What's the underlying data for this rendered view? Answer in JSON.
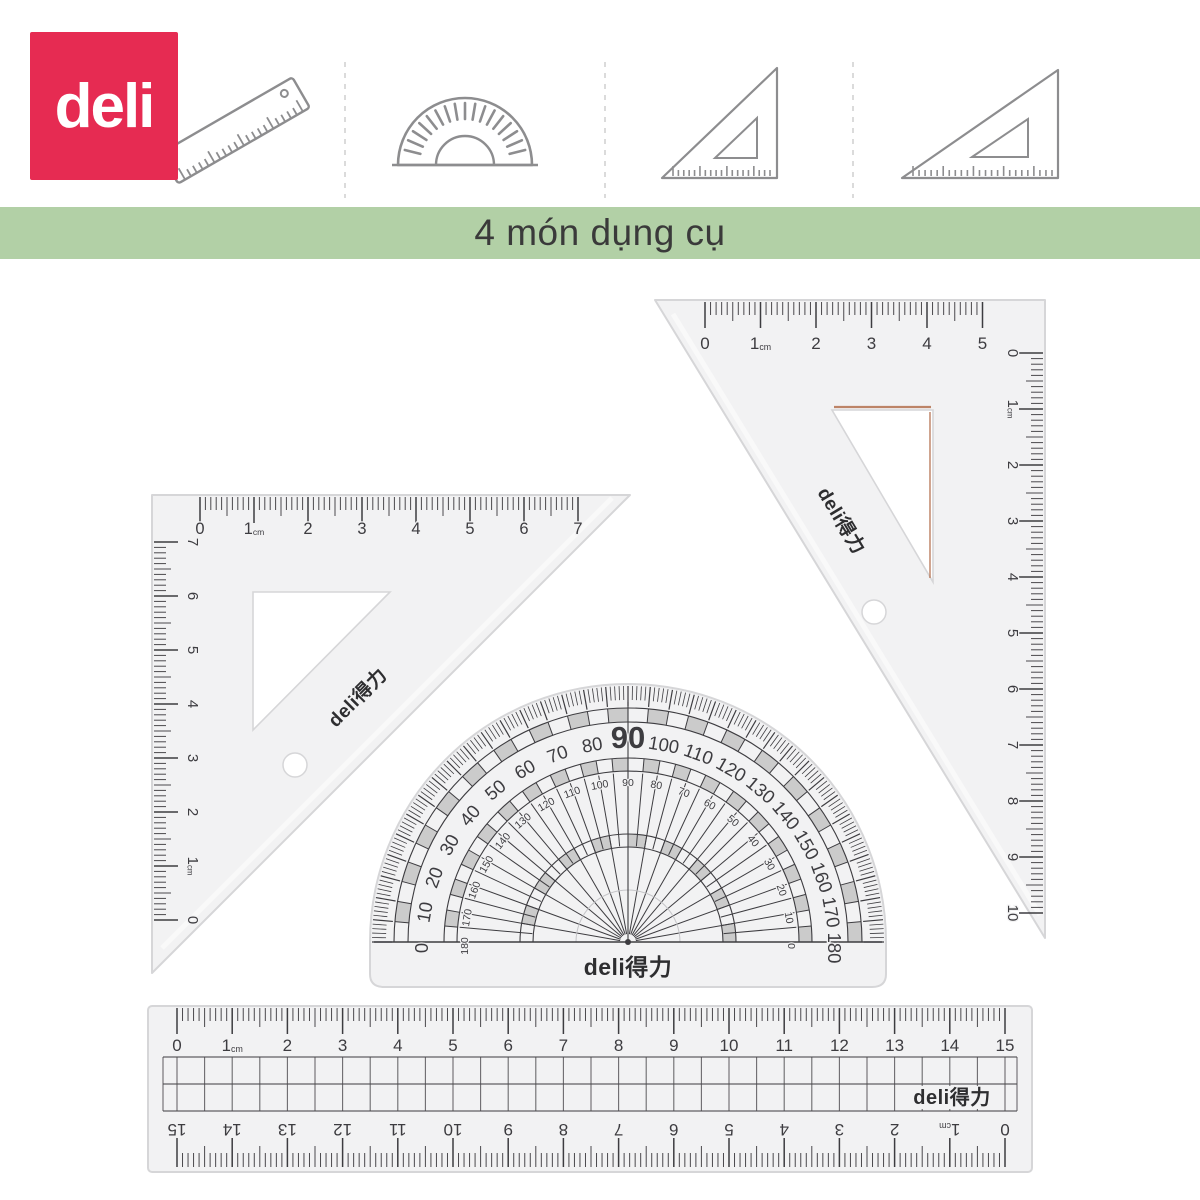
{
  "brand": {
    "logo_text": "deli",
    "logo_bg": "#e62b52",
    "logo_fg": "#ffffff",
    "mark_text": "deli得力"
  },
  "banner": {
    "text": "4 món dụng cụ",
    "bg": "#b2d0a6",
    "fg": "#3a3a3a"
  },
  "header": {
    "icons": [
      {
        "name": "ruler-icon"
      },
      {
        "name": "protractor-icon"
      },
      {
        "name": "set-square-45-icon"
      },
      {
        "name": "set-square-30-icon"
      }
    ]
  },
  "palette": {
    "tool_body": "#f2f2f3",
    "tool_edge": "#d6d6d8",
    "mark": "#3d3c40",
    "mark_light": "#4a484c",
    "icon_stroke": "#8d8d8f",
    "divider": "#d2d2d2",
    "copper": "#b4714f"
  },
  "tools": {
    "set_square_45": {
      "brand": "deli得力",
      "top_scale_labels": [
        "0",
        "1cm",
        "2",
        "3",
        "4",
        "5",
        "6",
        "7"
      ],
      "side_scale_labels": [
        "7",
        "6",
        "5",
        "4",
        "3",
        "2",
        "1cm",
        "0"
      ]
    },
    "set_square_30": {
      "brand": "deli得力",
      "top_scale_labels": [
        "0",
        "1cm",
        "2",
        "3",
        "4",
        "5"
      ],
      "side_scale_labels": [
        "0",
        "1cm",
        "2",
        "3",
        "4",
        "5",
        "6",
        "7",
        "8",
        "9",
        "10"
      ]
    },
    "protractor": {
      "brand": "deli得力",
      "outer_scale": [
        0,
        10,
        20,
        30,
        40,
        50,
        60,
        70,
        80,
        90,
        100,
        110,
        120,
        130,
        140,
        150,
        160,
        170,
        180
      ],
      "inner_scale": [
        180,
        170,
        160,
        150,
        140,
        130,
        120,
        110,
        100,
        90,
        80,
        70,
        60,
        50,
        40,
        30,
        20,
        10,
        0
      ],
      "emphasized_value": "90"
    },
    "ruler_15cm": {
      "brand": "deli得力",
      "top_scale_labels": [
        "0",
        "1cm",
        "2",
        "3",
        "4",
        "5",
        "6",
        "7",
        "8",
        "9",
        "10",
        "11",
        "12",
        "13",
        "14",
        "15"
      ],
      "bottom_scale_labels": [
        "15",
        "14",
        "13",
        "12",
        "11",
        "10",
        "9",
        "8",
        "7",
        "6",
        "5",
        "4",
        "3",
        "2",
        "1cm",
        "0"
      ]
    }
  }
}
